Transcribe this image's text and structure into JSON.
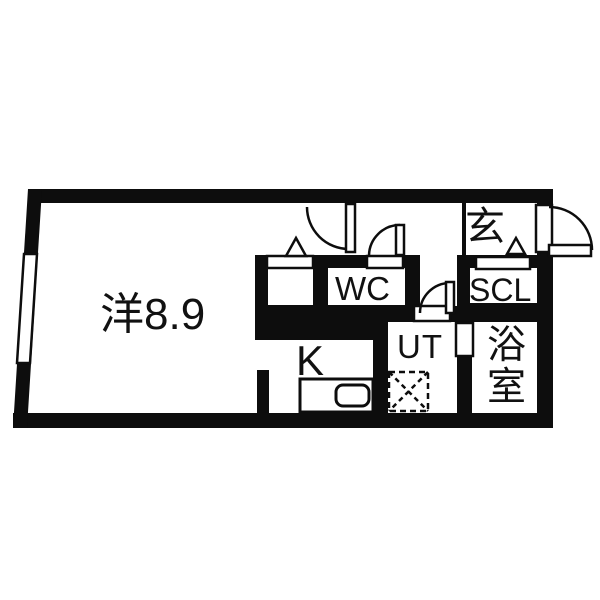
{
  "plan": {
    "rooms": {
      "living": {
        "label": "洋8.9"
      },
      "kitchen": {
        "label": "K"
      },
      "toilet": {
        "label": "WC"
      },
      "entrance": {
        "label": "玄"
      },
      "shoe_closet": {
        "label": "SCL"
      },
      "utility": {
        "label": "UT"
      },
      "bathroom": {
        "label": "浴室"
      }
    },
    "colors": {
      "wall": "#0d0d0d",
      "floor": "#ffffff"
    }
  }
}
